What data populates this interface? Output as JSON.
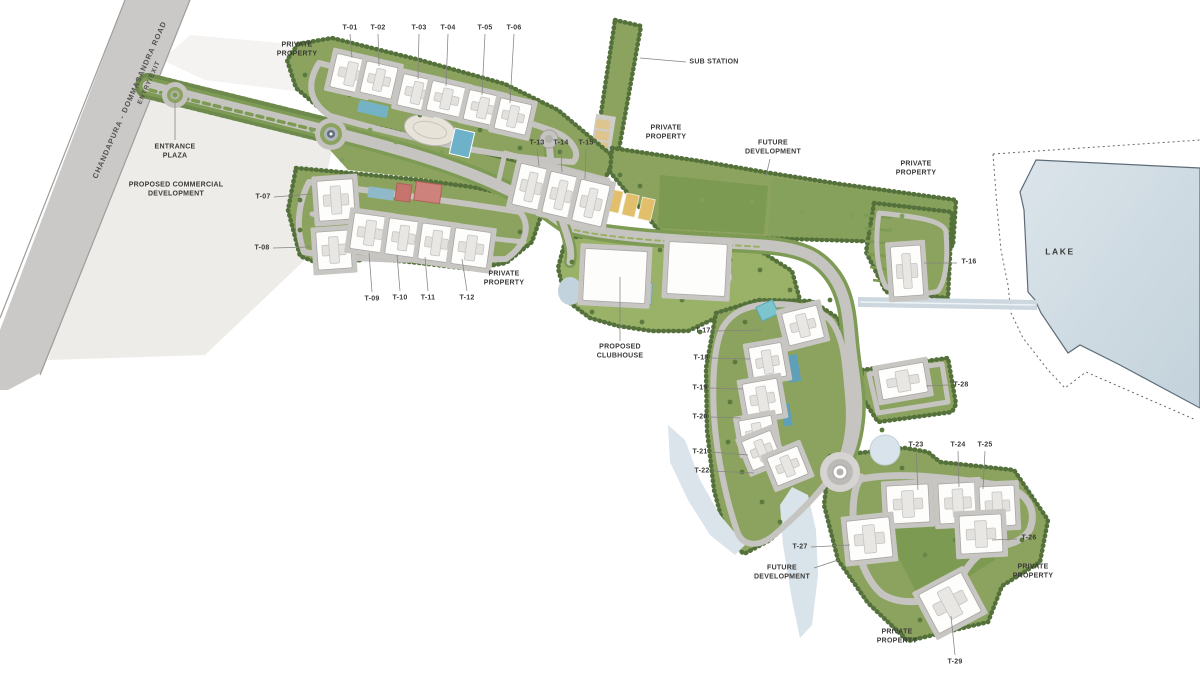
{
  "document": {
    "type": "township-site-master-plan"
  },
  "colors": {
    "site_green": "#8ba35e",
    "tree_green": "#55713b",
    "lawn_green": "#7d9a52",
    "road_gray": "#c6c4c1",
    "lake_blue": "#cdd9e1",
    "pool_blue": "#6db2c8",
    "court_yellow": "#e2bf6b",
    "school_red": "#c5756d",
    "label_ink": "#3a3a38"
  },
  "annotations": [
    {
      "id": "road-name",
      "text": "CHANDAPURA - DOMMASANDRA ROAD",
      "x": 130,
      "y": 100,
      "rot": -66,
      "size": 7.5,
      "cls": "road"
    },
    {
      "id": "entry-exit",
      "text": "ENTRY/EXIT",
      "x": 150,
      "y": 83,
      "rot": -66,
      "size": 6.5,
      "cls": "road"
    },
    {
      "id": "entrance-plaza",
      "text": "ENTRANCE\nPLAZA",
      "x": 175,
      "y": 152,
      "leader": [
        175,
        101,
        175,
        140
      ]
    },
    {
      "id": "proposed-commercial-development",
      "text": "PROPOSED COMMERCIAL\nDEVELOPMENT",
      "x": 176,
      "y": 190
    },
    {
      "id": "private-property-northwest",
      "text": "PRIVATE\nPROPERTY",
      "x": 297,
      "y": 50
    },
    {
      "id": "t-01",
      "text": "T-01",
      "x": 350,
      "y": 28,
      "leader": [
        350,
        34,
        352,
        58
      ]
    },
    {
      "id": "t-02",
      "text": "T-02",
      "x": 378,
      "y": 28,
      "leader": [
        378,
        34,
        379,
        66
      ]
    },
    {
      "id": "t-03",
      "text": "T-03",
      "x": 419,
      "y": 28,
      "leader": [
        419,
        34,
        418,
        79
      ]
    },
    {
      "id": "t-04",
      "text": "T-04",
      "x": 448,
      "y": 28,
      "leader": [
        448,
        34,
        446,
        86
      ]
    },
    {
      "id": "t-05",
      "text": "T-05",
      "x": 485,
      "y": 28,
      "leader": [
        485,
        34,
        482,
        95
      ]
    },
    {
      "id": "t-06",
      "text": "T-06",
      "x": 514,
      "y": 28,
      "leader": [
        514,
        34,
        510,
        103
      ]
    },
    {
      "id": "sub-station",
      "text": "SUB STATION",
      "x": 714,
      "y": 62,
      "leader": [
        640,
        58,
        686,
        62
      ]
    },
    {
      "id": "private-property-north",
      "text": "PRIVATE\nPROPERTY",
      "x": 666,
      "y": 133
    },
    {
      "id": "future-development-north",
      "text": "FUTURE\nDEVELOPMENT",
      "x": 773,
      "y": 148,
      "leader": [
        770,
        159,
        766,
        176
      ]
    },
    {
      "id": "private-property-east",
      "text": "PRIVATE\nPROPERTY",
      "x": 916,
      "y": 169
    },
    {
      "id": "t-13",
      "text": "T-13",
      "x": 537,
      "y": 143,
      "leader": [
        537,
        149,
        539,
        166
      ]
    },
    {
      "id": "t-14",
      "text": "T-14",
      "x": 561,
      "y": 143,
      "leader": [
        561,
        149,
        562,
        172
      ]
    },
    {
      "id": "t-15",
      "text": "T-15",
      "x": 586,
      "y": 143,
      "leader": [
        586,
        149,
        585,
        179
      ]
    },
    {
      "id": "t-07",
      "text": "T-07",
      "x": 263,
      "y": 197,
      "leader": [
        274,
        197,
        312,
        194
      ]
    },
    {
      "id": "t-08",
      "text": "T-08",
      "x": 262,
      "y": 248,
      "leader": [
        273,
        248,
        310,
        247
      ]
    },
    {
      "id": "t-09",
      "text": "T-09",
      "x": 372,
      "y": 299,
      "leader": [
        372,
        292,
        369,
        253
      ]
    },
    {
      "id": "t-10",
      "text": "T-10",
      "x": 400,
      "y": 298,
      "leader": [
        400,
        291,
        397,
        255
      ]
    },
    {
      "id": "t-11",
      "text": "T-11",
      "x": 428,
      "y": 298,
      "leader": [
        428,
        291,
        425,
        257
      ]
    },
    {
      "id": "t-12",
      "text": "T-12",
      "x": 467,
      "y": 298,
      "leader": [
        467,
        291,
        462,
        259
      ]
    },
    {
      "id": "private-property-south",
      "text": "PRIVATE\nPROPERTY",
      "x": 504,
      "y": 279
    },
    {
      "id": "proposed-clubhouse",
      "text": "PROPOSED\nCLUBHOUSE",
      "x": 620,
      "y": 352,
      "leader": [
        620,
        341,
        620,
        277
      ]
    },
    {
      "id": "t-16",
      "text": "T-16",
      "x": 969,
      "y": 262,
      "leader": [
        957,
        263,
        924,
        263
      ]
    },
    {
      "id": "lake",
      "text": "LAKE",
      "x": 1060,
      "y": 252,
      "size": 8.5,
      "cls": "big"
    },
    {
      "id": "t-17",
      "text": "T-17",
      "x": 703,
      "y": 331,
      "leader": [
        713,
        331,
        762,
        330
      ]
    },
    {
      "id": "t-18",
      "text": "T-18",
      "x": 701,
      "y": 358,
      "leader": [
        711,
        358,
        750,
        359
      ]
    },
    {
      "id": "t-19",
      "text": "T-19",
      "x": 700,
      "y": 388,
      "leader": [
        710,
        388,
        743,
        389
      ]
    },
    {
      "id": "t-20",
      "text": "T-20",
      "x": 700,
      "y": 417,
      "leader": [
        710,
        417,
        741,
        418
      ]
    },
    {
      "id": "t-21",
      "text": "T-21",
      "x": 700,
      "y": 452,
      "leader": [
        710,
        452,
        748,
        455
      ]
    },
    {
      "id": "t-22",
      "text": "T-22",
      "x": 702,
      "y": 471,
      "leader": [
        712,
        471,
        754,
        473
      ]
    },
    {
      "id": "t-28",
      "text": "T-28",
      "x": 961,
      "y": 385,
      "leader": [
        948,
        385,
        926,
        386
      ]
    },
    {
      "id": "t-23",
      "text": "T-23",
      "x": 916,
      "y": 445,
      "leader": [
        916,
        451,
        918,
        490
      ]
    },
    {
      "id": "t-24",
      "text": "T-24",
      "x": 958,
      "y": 445,
      "leader": [
        958,
        451,
        959,
        487
      ]
    },
    {
      "id": "t-25",
      "text": "T-25",
      "x": 985,
      "y": 445,
      "leader": [
        985,
        451,
        983,
        489
      ]
    },
    {
      "id": "t-26",
      "text": "T-26",
      "x": 1029,
      "y": 538,
      "leader": [
        1017,
        539,
        992,
        540
      ]
    },
    {
      "id": "private-property-southeast",
      "text": "PRIVATE\nPROPERTY",
      "x": 1033,
      "y": 572
    },
    {
      "id": "t-27",
      "text": "T-27",
      "x": 800,
      "y": 547,
      "leader": [
        811,
        547,
        850,
        545
      ]
    },
    {
      "id": "future-development-south",
      "text": "FUTURE\nDEVELOPMENT",
      "x": 782,
      "y": 573,
      "leader": [
        814,
        568,
        838,
        560
      ]
    },
    {
      "id": "private-property-bottom",
      "text": "PRIVATE\nPROPERTY",
      "x": 897,
      "y": 637
    },
    {
      "id": "t-29",
      "text": "T-29",
      "x": 955,
      "y": 662,
      "leader": [
        955,
        655,
        951,
        616
      ]
    }
  ]
}
